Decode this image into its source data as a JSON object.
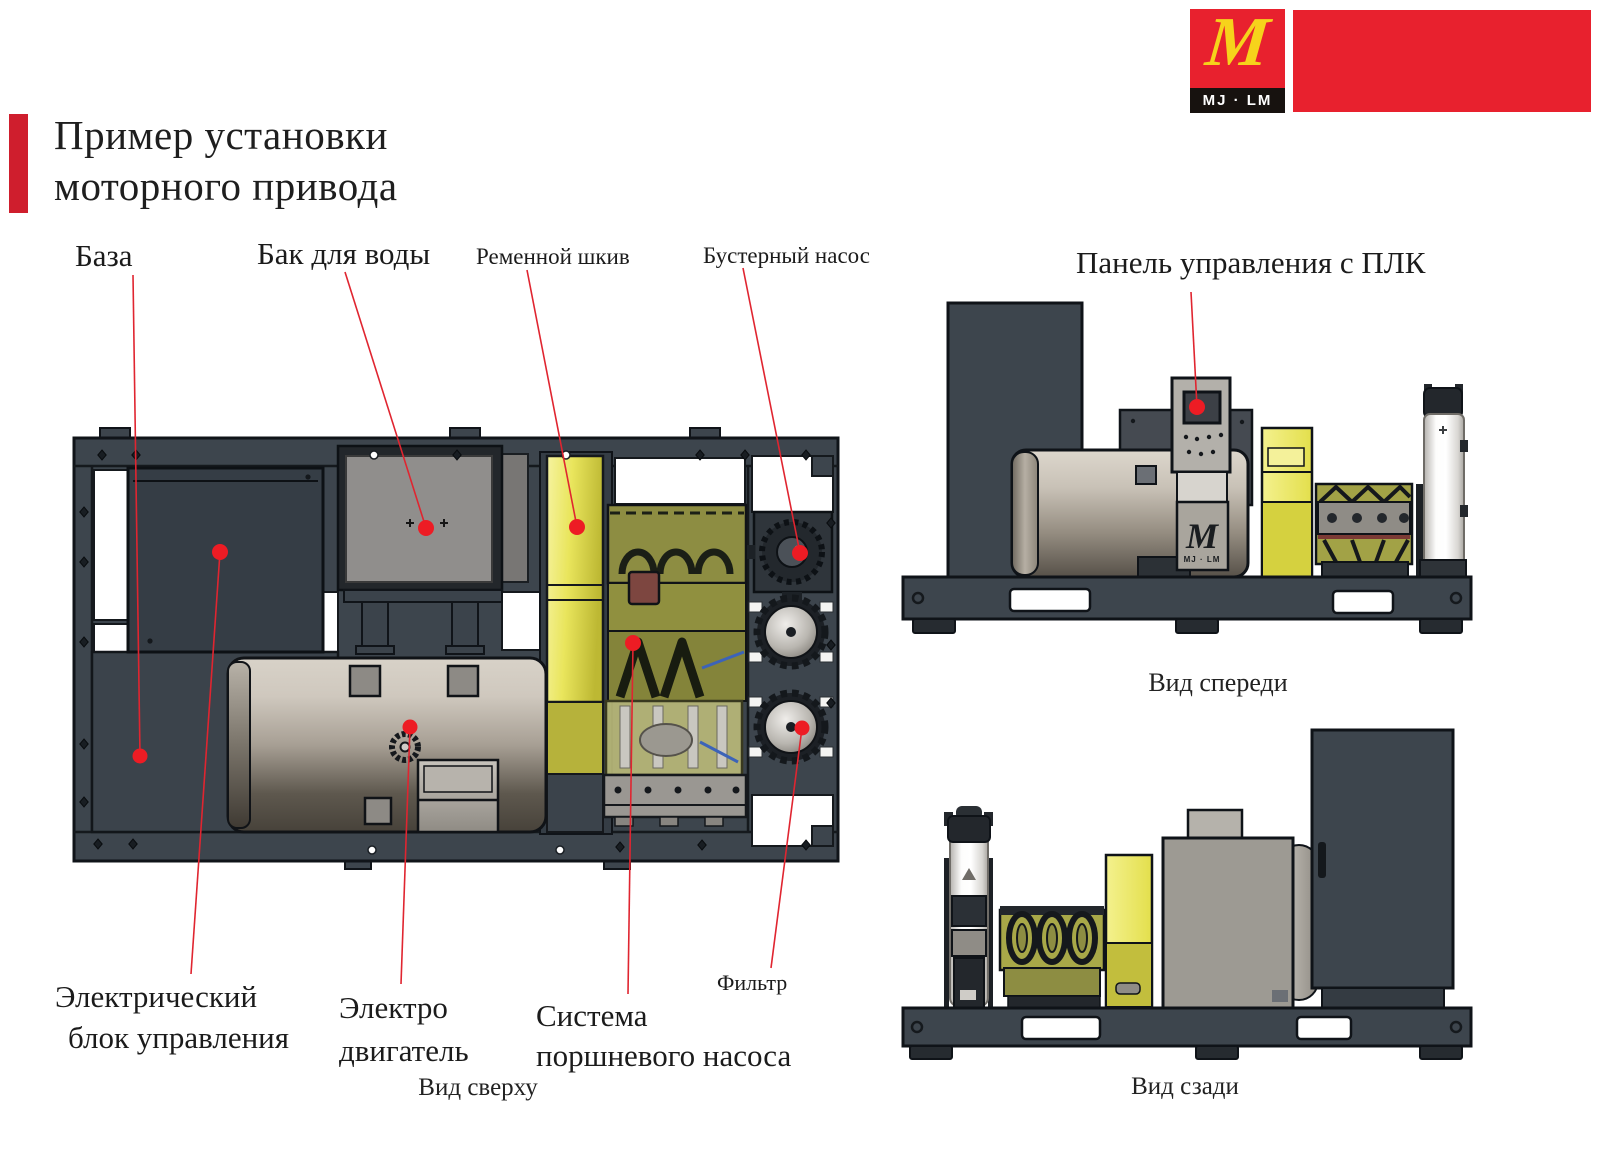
{
  "header": {
    "title_line1": "Пример установки",
    "title_line2": "моторного привода"
  },
  "logo": {
    "monogram": "M",
    "brand": "MJ · LM"
  },
  "component_labels": {
    "base": "База",
    "water_tank": "Бак для воды",
    "belt_pulley": "Ременной шкив",
    "booster_pump": "Бустерный насос",
    "plc_panel": "Панель управления с ПЛК",
    "electrical_unit_line1": "Электрический",
    "electrical_unit_line2": "блок управления",
    "electric_motor_line1": "Электро",
    "electric_motor_line2": "двигатель",
    "piston_pump_line1": "Система",
    "piston_pump_line2": "поршневого насоса",
    "filter": "Фильтр"
  },
  "view_captions": {
    "top": "Вид сверху",
    "front": "Вид спереди",
    "rear": "Вид сзади"
  },
  "colors": {
    "accent_red": "#e02530",
    "logo_red": "#e8212e",
    "logo_yellow": "#f6d31b",
    "frame_dark": "#3d454d",
    "pulley_yellow": "#e6e24a",
    "pump_olive": "#8d8d42",
    "motor_silver": "#cfc8be",
    "tank_gray": "#908e8c"
  }
}
